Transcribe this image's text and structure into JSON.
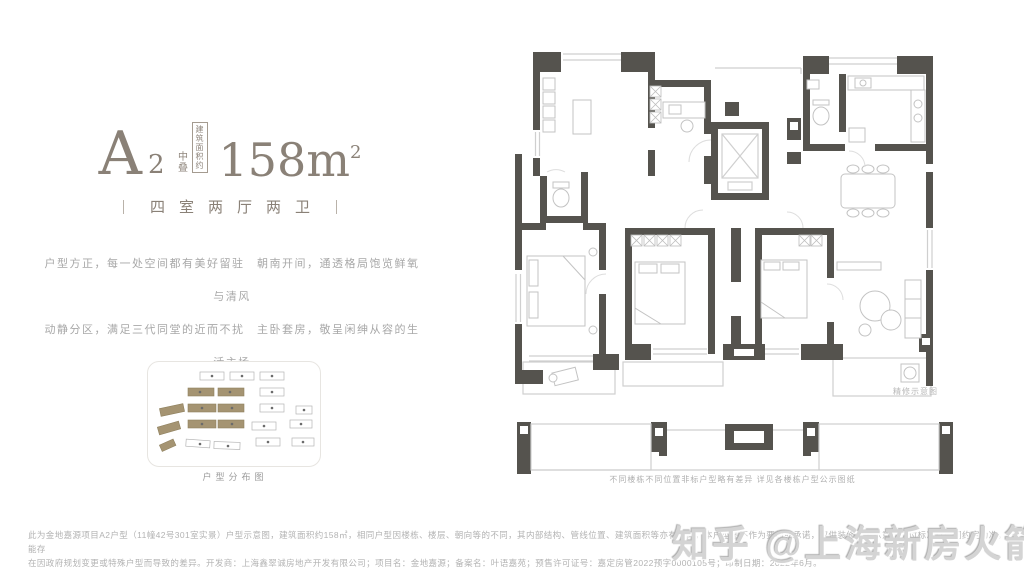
{
  "header": {
    "plan_code_letter": "A",
    "plan_code_number": "2",
    "tier_label": "中叠",
    "area_box_line1": "建筑",
    "area_box_line2": "面积约",
    "area_value": "158m",
    "area_sup": "2",
    "subtitle": "四室两厅两卫"
  },
  "description": {
    "line1": "户型方正，每一处空间都有美好留驻　朝南开间，通透格局饱览鲜氧与清风",
    "line2": "动静分区，满足三代同堂的近而不扰　主卧套房，敬呈闲绅从容的生活主场"
  },
  "site_plan": {
    "caption": "户型分布图"
  },
  "floor_plan": {
    "caption_side": "精修示意图",
    "caption_bottom": "不同楼栋不同位置非标户型略有差异 详见各楼栋户型公示图纸"
  },
  "disclaimer": {
    "line1": "此为金地嘉源项目A2户型（11幢42号301室实景）户型示意图，建筑面积约158㎡，相同户型因楼栋、楼层、朝向等的不同，其内部结构、管线位置、建筑面积等亦有不同，本户型图不作为要约或承诺，仅供装修参考示意，交付标准以合同约定为准，可能存",
    "line2": "在因政府规划变更或特殊户型而导致的差异。开发商：上海鑫翠诚房地产开发有限公司；项目名：金地嘉源；备案名：叶语嘉苑；预售许可证号：嘉定房管2022预字0000105号；印制日期：2022年6月。"
  },
  "watermark": {
    "text": "知乎 @上海新房火箭哥"
  },
  "colors": {
    "accent": "#8A8177",
    "wall": "#55534E",
    "building_tan": "#A59472",
    "watermark_gray": "#D4D4D4"
  }
}
